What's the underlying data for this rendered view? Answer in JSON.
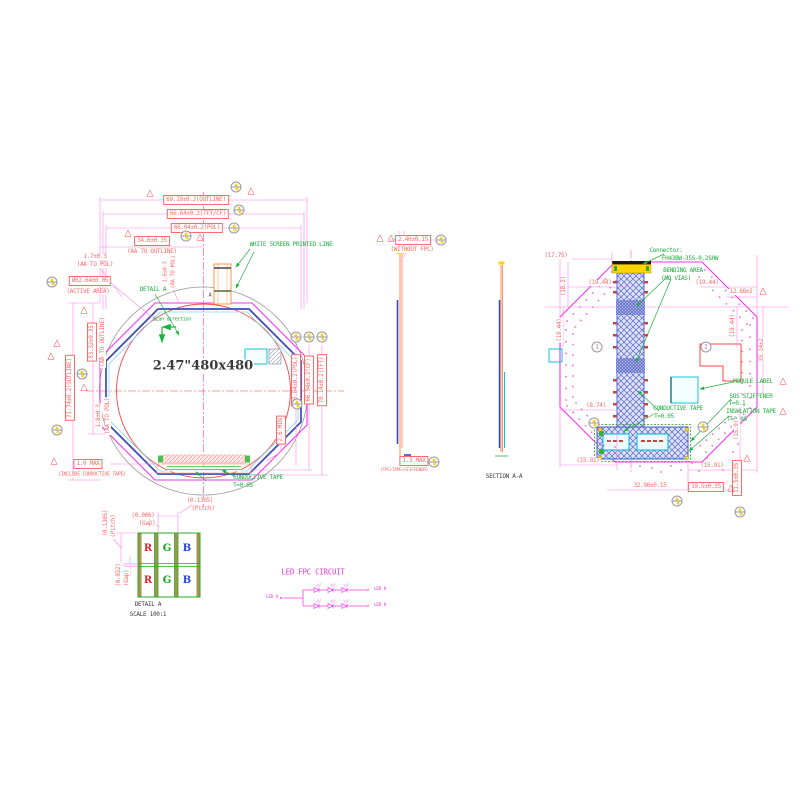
{
  "colors": {
    "dim": "#ff6a6a",
    "grn": "#1fae3f",
    "blk": "#3a3a3a",
    "mag": "#e83ce0",
    "red": "#d82828",
    "pgrn": "#169c16",
    "pblu": "#2742d8"
  },
  "labels": [
    {
      "n": "dim-outline-width",
      "t": "69.19±0.2(OUTLINE)",
      "x": 196,
      "y": 200,
      "b": 1
    },
    {
      "n": "dim-tftcf-width",
      "t": "66.64±0.2(TFT/CF)",
      "x": 198,
      "y": 214,
      "b": 1
    },
    {
      "n": "dim-pol-width",
      "t": "66.04±0.2(POL)",
      "x": 197,
      "y": 228,
      "b": 1
    },
    {
      "n": "dim-aa-to-outline-h",
      "t": "34.6±0.35",
      "x": 152,
      "y": 241,
      "b": 1
    },
    {
      "n": "dim-aa-to-outline-h-sub",
      "t": "(AA TO OUTLINE)",
      "x": 152,
      "y": 252
    },
    {
      "n": "dim-aa-to-pol-left",
      "t": "1.7±0.3",
      "x": 95,
      "y": 257
    },
    {
      "n": "dim-aa-to-pol-left-sub",
      "t": "(AA TO POL)",
      "x": 95,
      "y": 265
    },
    {
      "n": "dim-active-area",
      "t": "Ø62.64±0.05",
      "x": 90,
      "y": 281,
      "b": 1
    },
    {
      "n": "dim-active-area-sub",
      "t": "(ACTIVE AREA)",
      "x": 88,
      "y": 292
    },
    {
      "n": "detail-a-ref",
      "t": "DETAIL A",
      "x": 153,
      "y": 290,
      "c": "grn"
    },
    {
      "n": "white-screen-note",
      "t": "WHITE SCREEN PRINTED LINE",
      "x": 291,
      "y": 245,
      "c": "grn"
    },
    {
      "n": "scan-direction-label",
      "t": "Scan direction",
      "x": 172,
      "y": 320,
      "c": "grn",
      "s": 5
    },
    {
      "n": "display-size-text",
      "t": "2.47\"480x480",
      "x": 203,
      "y": 366,
      "c": "blk",
      "s": 13,
      "f": "serif"
    },
    {
      "n": "dim-outline-height",
      "t": "71.74±0.2(OUTLINE)",
      "x": 70,
      "y": 388,
      "r": 1,
      "b": 1
    },
    {
      "n": "dim-aa-to-outline-v",
      "t": "53.32±0.35",
      "x": 92,
      "y": 342,
      "r": 1,
      "b": 1
    },
    {
      "n": "dim-aa-to-outline-v-sub",
      "t": "(AA TO OUTLINE)",
      "x": 103,
      "y": 342,
      "r": 1
    },
    {
      "n": "dim-aa-to-pol-bottom",
      "t": "1.8±0.3",
      "x": 99,
      "y": 416,
      "r": 1
    },
    {
      "n": "dim-aa-to-pol-bottom-sub",
      "t": "(AA TO POL)",
      "x": 108,
      "y": 416,
      "r": 1
    },
    {
      "n": "dim-aa-to-pol-top",
      "t": "1.6±0.3",
      "x": 166,
      "y": 272,
      "r": 1,
      "s": 5.5
    },
    {
      "n": "dim-aa-to-pol-top-sub",
      "t": "(AA TO POL)",
      "x": 174,
      "y": 272,
      "r": 1,
      "s": 5.5
    },
    {
      "n": "dim-tape-max",
      "t": "1.0 MAX",
      "x": 88,
      "y": 464,
      "b": 1
    },
    {
      "n": "dim-tape-max-sub",
      "t": "(INCLUDE CONDUCTIVE TAPE)",
      "x": 92,
      "y": 475,
      "s": 5
    },
    {
      "n": "conductive-tape-note-front",
      "t": "CONDUCTIVE TAPE",
      "x": 258,
      "y": 478,
      "c": "grn"
    },
    {
      "n": "conductive-tape-thickness-front",
      "t": "T=0.05",
      "x": 243,
      "y": 486,
      "c": "grn"
    },
    {
      "n": "dim-pol-height",
      "t": "65.84±0.2(POL)",
      "x": 296,
      "y": 380,
      "r": 1,
      "b": 1
    },
    {
      "n": "dim-cf-height",
      "t": "66.94±0.2(CF)",
      "x": 309,
      "y": 380,
      "r": 1,
      "b": 1
    },
    {
      "n": "dim-tft-height",
      "t": "70.14±0.2(TFT)",
      "x": 322,
      "y": 380,
      "r": 1,
      "b": 1
    },
    {
      "n": "dim-min-clearance",
      "t": "2.6 MIN",
      "x": 281,
      "y": 430,
      "r": 1,
      "b": 1
    },
    {
      "n": "section-cut-mark",
      "t": "A",
      "x": 210,
      "y": 296,
      "c": "blk",
      "s": 5
    },
    {
      "n": "dim-module-thickness",
      "t": "2.40±0.15",
      "x": 413,
      "y": 240,
      "b": 1
    },
    {
      "n": "dim-module-thickness-sub",
      "t": "(WITHOUT FPC)",
      "x": 412,
      "y": 250
    },
    {
      "n": "dim-fpc-stack",
      "t": "1.3 MAX",
      "x": 414,
      "y": 461,
      "b": 1
    },
    {
      "n": "dim-fpc-stack-sub",
      "t": "(FPC+TAPE+STIFFENER)",
      "x": 404,
      "y": 471,
      "s": 4.5
    },
    {
      "n": "section-title",
      "t": "SECTION A-A",
      "x": 504,
      "y": 477,
      "c": "blk"
    },
    {
      "n": "connector-note-line1",
      "t": "Connector:",
      "x": 666,
      "y": 251,
      "c": "grn"
    },
    {
      "n": "connector-note-line2",
      "t": "FH43BW-35S-0.2SHW",
      "x": 690,
      "y": 259,
      "c": "grn"
    },
    {
      "n": "bending-area-note",
      "t": "BENDING AREA",
      "x": 683,
      "y": 271,
      "c": "grn"
    },
    {
      "n": "bending-area-note-sub",
      "t": "(NO VIAS)",
      "x": 676,
      "y": 279,
      "c": "grn"
    },
    {
      "n": "dim-17-75",
      "t": "(17.75)",
      "x": 556,
      "y": 256
    },
    {
      "n": "dim-18-3",
      "t": "(18.3)",
      "x": 564,
      "y": 286,
      "r": 1
    },
    {
      "n": "dim-19-44-a",
      "t": "(19.44)",
      "x": 600,
      "y": 283
    },
    {
      "n": "dim-19-44-b",
      "t": "(19.44)",
      "x": 560,
      "y": 330,
      "r": 1
    },
    {
      "n": "dim-19-44-c",
      "t": "(19.44)",
      "x": 707,
      "y": 283
    },
    {
      "n": "dim-12-68",
      "t": "12.68±2",
      "x": 741,
      "y": 292
    },
    {
      "n": "dim-19-44-d",
      "t": "(19.44)",
      "x": 733,
      "y": 326,
      "r": 1
    },
    {
      "n": "dim-35-14",
      "t": "35.14±2",
      "x": 762,
      "y": 350,
      "r": 1
    },
    {
      "n": "dim-8-74",
      "t": "(8.74)",
      "x": 596,
      "y": 406
    },
    {
      "n": "module-label-note",
      "t": "MODULE LABEL",
      "x": 753,
      "y": 382,
      "c": "grn"
    },
    {
      "n": "sus-stiffener-note",
      "t": "SUS STIFFENER",
      "x": 751,
      "y": 397,
      "c": "grn"
    },
    {
      "n": "sus-stiffener-thickness",
      "t": "T=0.1",
      "x": 737,
      "y": 404,
      "c": "grn"
    },
    {
      "n": "conductive-tape-note-rear",
      "t": "CONDUCTIVE TAPE",
      "x": 678,
      "y": 409,
      "c": "grn"
    },
    {
      "n": "conductive-tape-thickness-rear",
      "t": "T=0.05",
      "x": 664,
      "y": 417,
      "c": "grn"
    },
    {
      "n": "insulation-tape-note",
      "t": "INSULATION TAPE",
      "x": 751,
      "y": 412,
      "c": "grn"
    },
    {
      "n": "insulation-tape-thickness",
      "t": "T=0.08",
      "x": 737,
      "y": 420,
      "c": "grn"
    },
    {
      "n": "dim-15-91-left",
      "t": "(15.91)",
      "x": 588,
      "y": 461
    },
    {
      "n": "dim-15-91-right",
      "t": "(15.91)",
      "x": 712,
      "y": 466
    },
    {
      "n": "dim-15-9",
      "t": "(15.9)",
      "x": 737,
      "y": 430,
      "r": 1
    },
    {
      "n": "dim-32-98",
      "t": "32.98±0.15",
      "x": 650,
      "y": 486
    },
    {
      "n": "dim-19-5",
      "t": "19.5±0.35",
      "x": 706,
      "y": 487,
      "b": 1
    },
    {
      "n": "dim-11-5",
      "t": "11.5±0.35",
      "x": 737,
      "y": 478,
      "r": 1,
      "b": 1
    },
    {
      "n": "da-pitch-h",
      "t": "(0.1305)",
      "x": 200,
      "y": 501
    },
    {
      "n": "da-pitch-h-sub",
      "t": "(Pitch)",
      "x": 203,
      "y": 509
    },
    {
      "n": "da-gap-h",
      "t": "(0.006)",
      "x": 143,
      "y": 516
    },
    {
      "n": "da-gap-h-sub",
      "t": "(Gap)",
      "x": 147,
      "y": 524
    },
    {
      "n": "da-pitch-v",
      "t": "(0.1305)",
      "x": 106,
      "y": 523,
      "r": 1
    },
    {
      "n": "da-pitch-v-sub",
      "t": "(Pitch)",
      "x": 114,
      "y": 526,
      "r": 1
    },
    {
      "n": "da-gap-v",
      "t": "(0.032)",
      "x": 119,
      "y": 575,
      "r": 1
    },
    {
      "n": "da-gap-v-sub",
      "t": "(Gap)",
      "x": 127,
      "y": 578,
      "r": 1
    },
    {
      "n": "subpixel-r1",
      "t": "R",
      "x": 148,
      "y": 549,
      "c": "red",
      "s": 10,
      "f": "serif"
    },
    {
      "n": "subpixel-g1",
      "t": "G",
      "x": 167,
      "y": 549,
      "c": "pgrn",
      "s": 10,
      "f": "serif"
    },
    {
      "n": "subpixel-b1",
      "t": "B",
      "x": 187,
      "y": 549,
      "c": "pblu",
      "s": 10,
      "f": "serif"
    },
    {
      "n": "subpixel-r2",
      "t": "R",
      "x": 148,
      "y": 581,
      "c": "red",
      "s": 10,
      "f": "serif"
    },
    {
      "n": "subpixel-g2",
      "t": "G",
      "x": 167,
      "y": 581,
      "c": "pgrn",
      "s": 10,
      "f": "serif"
    },
    {
      "n": "subpixel-b2",
      "t": "B",
      "x": 187,
      "y": 581,
      "c": "pblu",
      "s": 10,
      "f": "serif"
    },
    {
      "n": "detail-a-title",
      "t": "DETAIL A",
      "x": 148,
      "y": 605,
      "c": "blk"
    },
    {
      "n": "detail-a-scale",
      "t": "SCALE 100:1",
      "x": 148,
      "y": 615,
      "c": "blk"
    },
    {
      "n": "led-circuit-title",
      "t": "LED FPC CIRCUIT",
      "x": 313,
      "y": 572,
      "c": "mag",
      "s": 7.5
    },
    {
      "n": "led-anode-label",
      "t": "LED A",
      "x": 272,
      "y": 598,
      "c": "mag",
      "s": 4.5
    },
    {
      "n": "led-cathode-label-1",
      "t": "LED K",
      "x": 380,
      "y": 590,
      "c": "mag",
      "s": 4.5
    },
    {
      "n": "led-cathode-label-2",
      "t": "LED K",
      "x": 380,
      "y": 606,
      "c": "mag",
      "s": 4.5
    }
  ],
  "balloons": [
    {
      "x": 236,
      "y": 187
    },
    {
      "x": 239,
      "y": 210
    },
    {
      "x": 234,
      "y": 228
    },
    {
      "x": 186,
      "y": 236
    },
    {
      "x": 52,
      "y": 282
    },
    {
      "x": 82,
      "y": 374
    },
    {
      "x": 57,
      "y": 430
    },
    {
      "x": 296,
      "y": 337
    },
    {
      "x": 309,
      "y": 337
    },
    {
      "x": 322,
      "y": 337
    },
    {
      "x": 297,
      "y": 404
    },
    {
      "x": 441,
      "y": 240
    },
    {
      "x": 434,
      "y": 462
    },
    {
      "x": 597,
      "y": 347,
      "n": "1"
    },
    {
      "x": 706,
      "y": 347,
      "n": "2"
    },
    {
      "x": 594,
      "y": 423
    },
    {
      "x": 703,
      "y": 427
    },
    {
      "x": 677,
      "y": 501
    },
    {
      "x": 740,
      "y": 512
    }
  ],
  "triangles": [
    {
      "x": 150,
      "y": 194
    },
    {
      "x": 251,
      "y": 192
    },
    {
      "x": 128,
      "y": 234
    },
    {
      "x": 200,
      "y": 238
    },
    {
      "x": 84,
      "y": 311
    },
    {
      "x": 57,
      "y": 344
    },
    {
      "x": 51,
      "y": 357
    },
    {
      "x": 84,
      "y": 388
    },
    {
      "x": 54,
      "y": 462
    },
    {
      "x": 380,
      "y": 239
    },
    {
      "x": 391,
      "y": 239
    },
    {
      "x": 763,
      "y": 292
    },
    {
      "x": 731,
      "y": 489
    },
    {
      "x": 747,
      "y": 459
    },
    {
      "x": 783,
      "y": 382
    },
    {
      "x": 783,
      "y": 412
    }
  ]
}
